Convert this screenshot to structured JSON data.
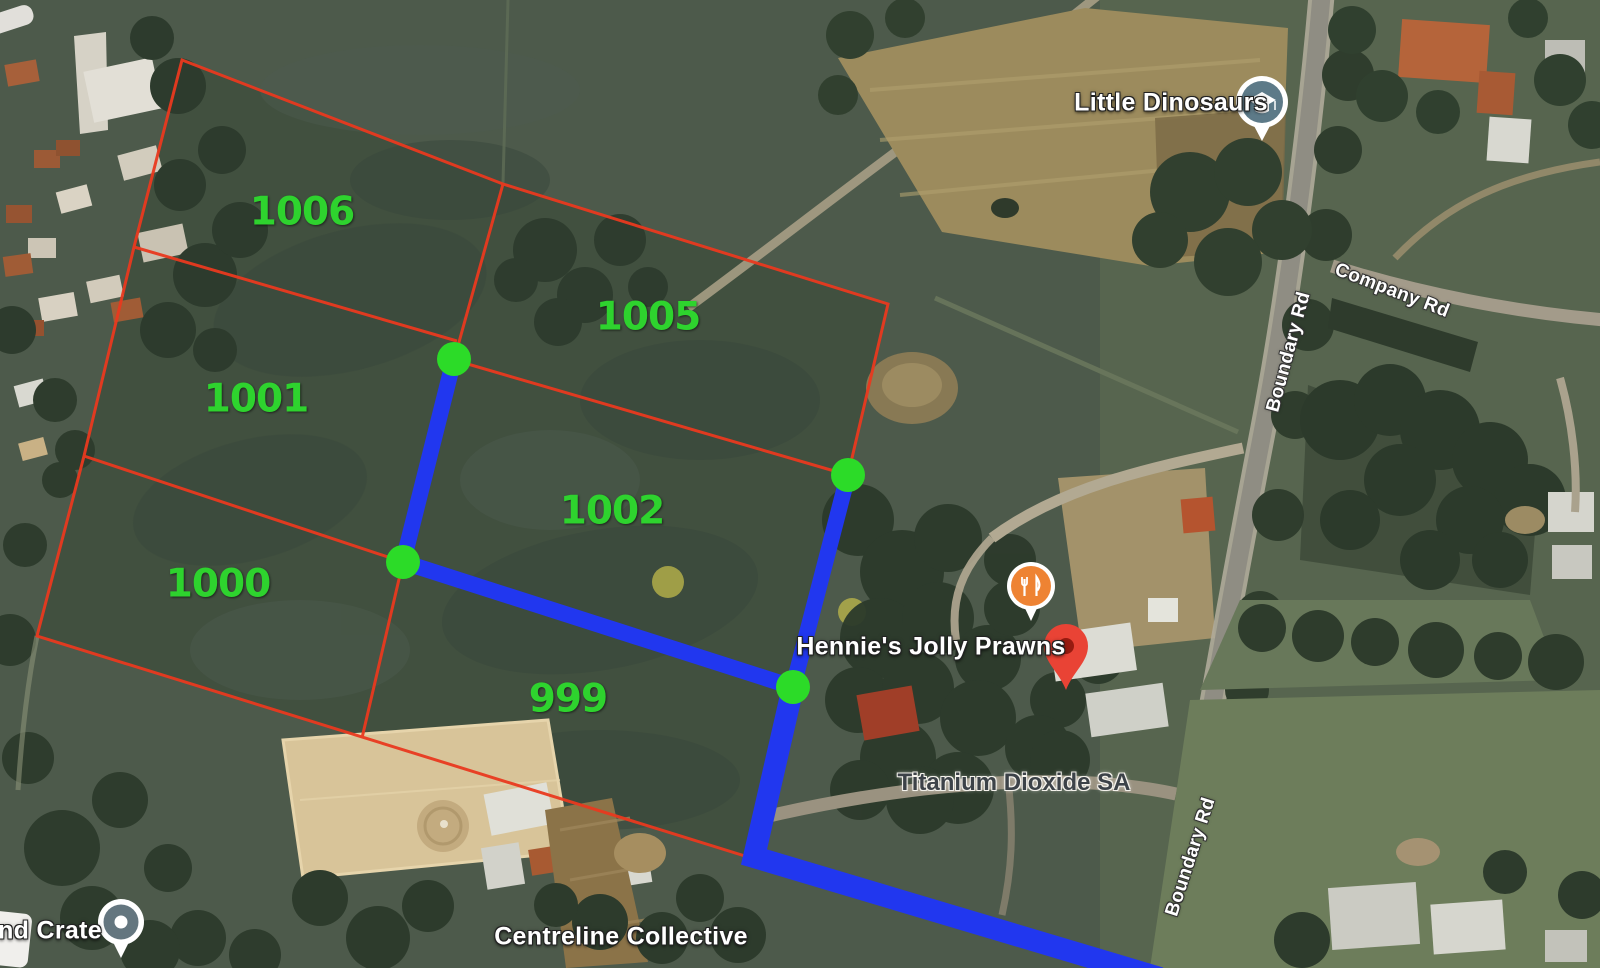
{
  "map": {
    "parcel_labels": [
      {
        "id": "1006"
      },
      {
        "id": "1005"
      },
      {
        "id": "1001"
      },
      {
        "id": "1002"
      },
      {
        "id": "1000"
      },
      {
        "id": "999"
      }
    ],
    "place_labels": [
      {
        "name": "Little Dinosaurs",
        "type": "education"
      },
      {
        "name": "Hennie's Jolly Prawns",
        "type": "restaurant"
      },
      {
        "name": "Titanium Dioxide SA",
        "type": "business"
      },
      {
        "name": "Centreline Collective",
        "type": "business"
      },
      {
        "name": "nd Crate",
        "type": "store"
      }
    ],
    "road_labels": [
      {
        "name": "Company Rd"
      },
      {
        "name": "Boundary Rd"
      },
      {
        "name": "Boundary Rd"
      }
    ],
    "overlay_colors": {
      "parcel_boundary": "#e9391f",
      "route_line": "#2137ef",
      "route_vertex": "#2cdb28",
      "parcel_label": "#2ed32e",
      "place_pin_red": "#e94335",
      "restaurant_pin_orange": "#ee8333",
      "education_pin_grey": "#5d7a88"
    }
  }
}
